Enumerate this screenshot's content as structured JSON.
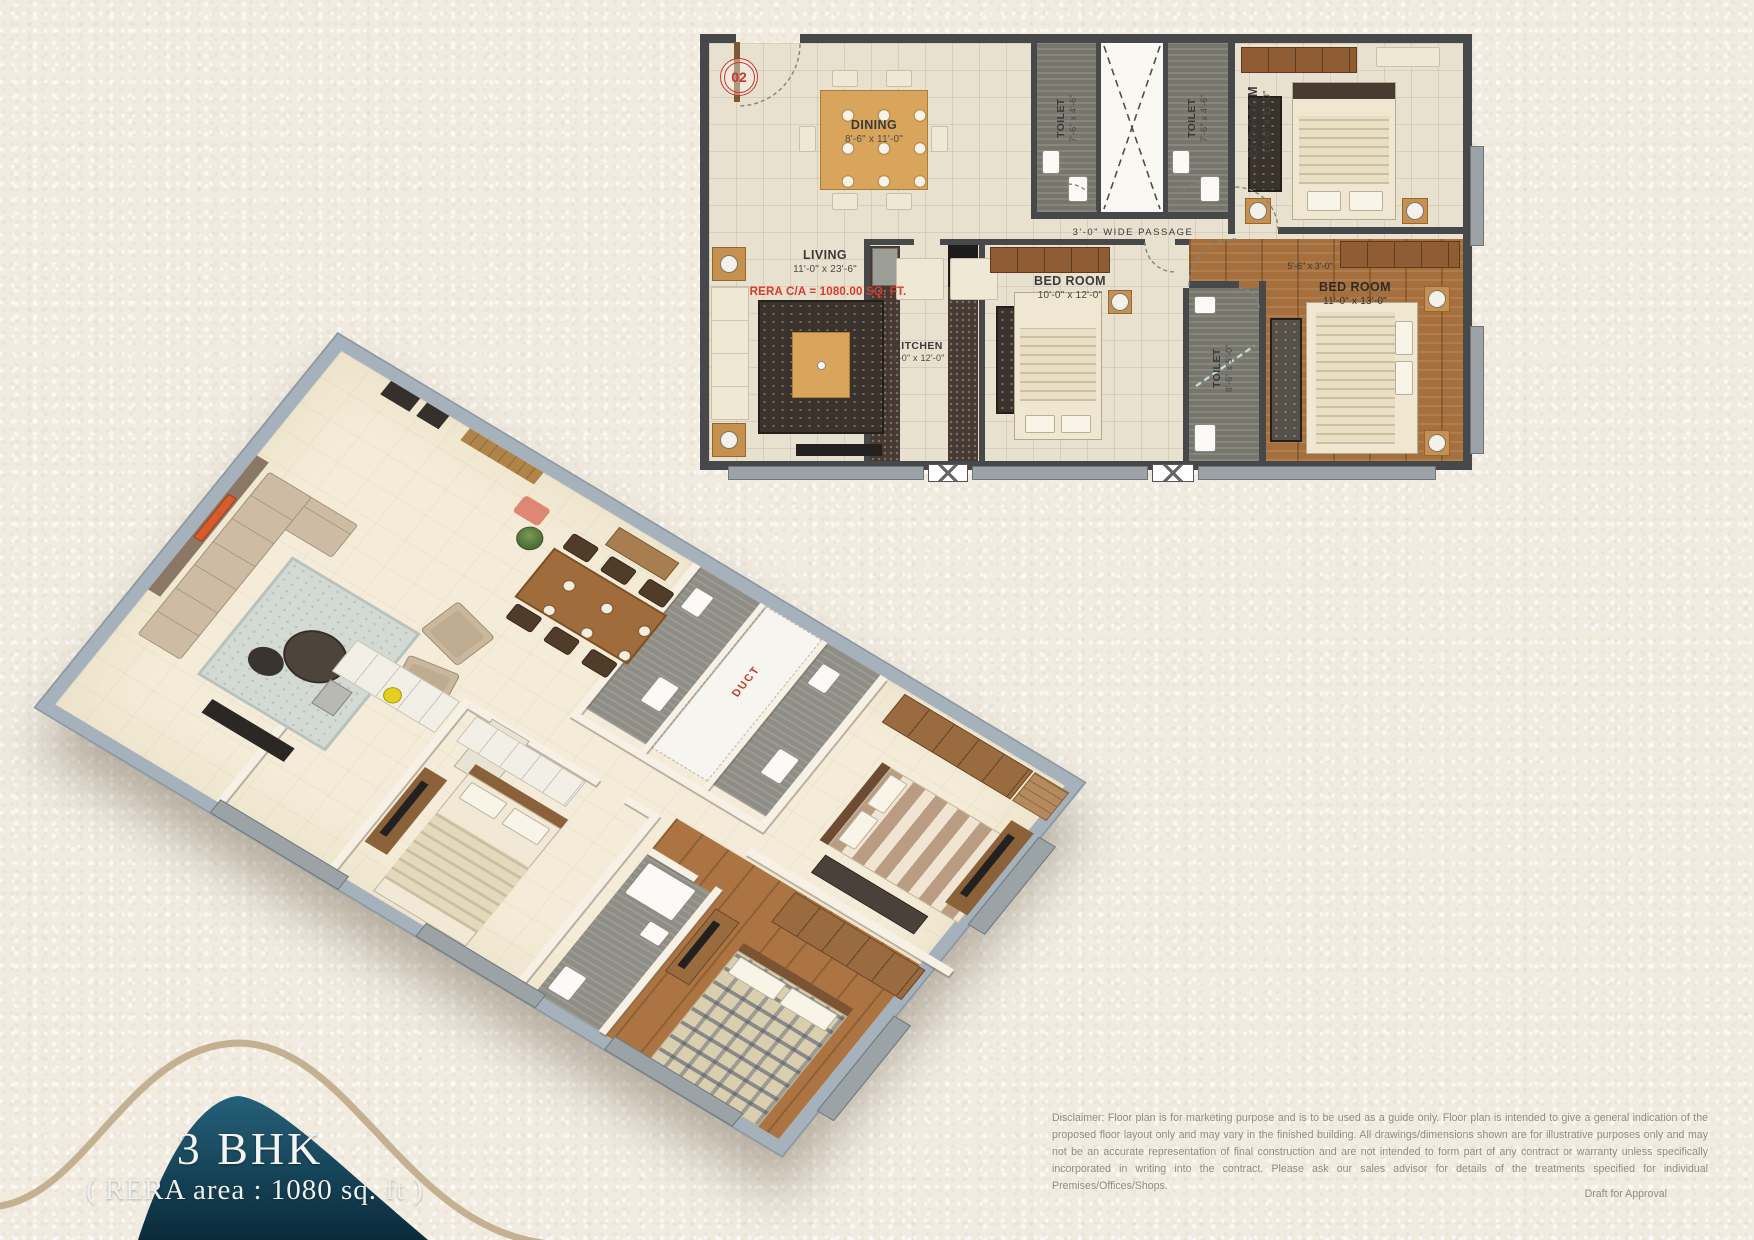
{
  "plan2d": {
    "unit_number": "02",
    "living": {
      "label": "LIVING",
      "dim": "11'-0\" x 23'-6\"",
      "rera": "RERA C/A = 1080.00 SQ. FT."
    },
    "dining": {
      "label": "DINING",
      "dim": "8'-6\" x 11'-0\""
    },
    "kitchen": {
      "label": "KITCHEN",
      "dim": "8'-0\" x 12'-0\""
    },
    "toilet1": {
      "label": "TOILET",
      "dim": "7'-6\" x 4'-6\""
    },
    "toilet2": {
      "label": "TOILET",
      "dim": "7'-6\" x 4'-6\""
    },
    "toilet3": {
      "label": "TOILET",
      "dim": "8'-6\" x 5'-0\""
    },
    "bedroom1": {
      "label": "BED ROOM",
      "dim": "13'-0\" x 11'-0\""
    },
    "bedroom2": {
      "label": "BED ROOM",
      "dim": "10'-0\" x 12'-0\""
    },
    "bedroom3": {
      "label": "BED ROOM",
      "dim": "11'-0\" x 13'-0\""
    },
    "passage": "3'-0\"  WIDE  PASSAGE",
    "foyer_dim": "5'-6\" x 3'-0\""
  },
  "plan3d": {
    "duct": "DUCT"
  },
  "badge": {
    "title": "3 BHK",
    "subtitle": "( RERA area : 1080 sq. ft )"
  },
  "footer": {
    "disclaimer": "Disclaimer: Floor plan is for marketing purpose and is to be used as a guide only. Floor plan is intended to give a general indication of the proposed floor layout only and may vary in the finished building. All drawings/dimensions shown are for illustrative purposes only and may not be an accurate representation of final construction and are not intended to form part of any contract or warranty unless specifically incorporated in writing into the contract. Please ask our sales advisor for details of the treatments specified for individual Premises/Offices/Shops.",
    "draft": "Draft for Approval"
  },
  "colors": {
    "accent_red": "#cf3426",
    "teal_dark": "#0a2b3a",
    "teal_light": "#25607a",
    "gold": "#c3b191"
  }
}
